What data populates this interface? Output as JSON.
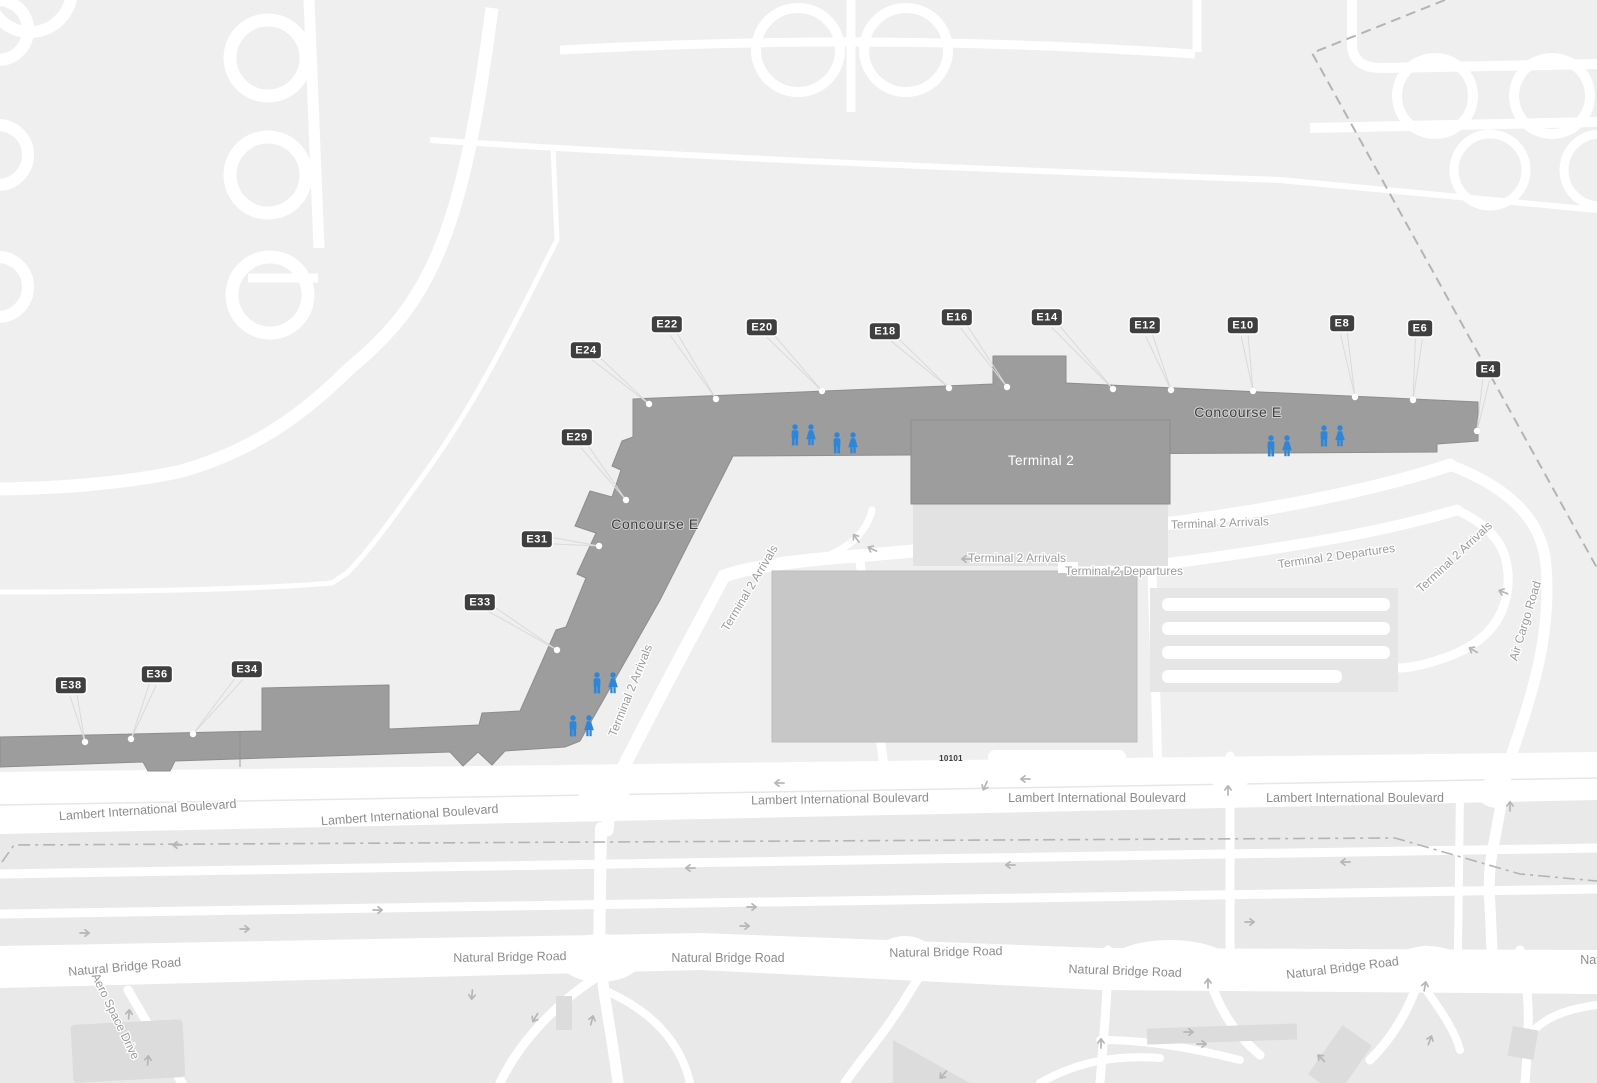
{
  "colors": {
    "map_bg": "#efefef",
    "south_bg": "#e9e9e9",
    "road": "#ffffff",
    "building": "#9d9d9d",
    "building_edge": "#8d8d8d",
    "terminal_apron": "#e2e2e2",
    "garage": "#c7c7c7",
    "badge_bg": "#3f3f3f",
    "badge_text": "#ffffff",
    "label_gray": "#9b9b9b",
    "leader_line": "#dadada",
    "dash_line": "#b4b4b4",
    "arrow": "#b6b6b6",
    "restroom_blue": "#2e86d8"
  },
  "buildings": {
    "concourse_label": "Concourse E",
    "terminal_label": "Terminal 2",
    "garage_address": "10101"
  },
  "gates": [
    {
      "label": "E4",
      "x": 1488,
      "y": 369,
      "dot": [
        1477,
        431
      ]
    },
    {
      "label": "E6",
      "x": 1420,
      "y": 328,
      "dot": [
        1413,
        400
      ]
    },
    {
      "label": "E8",
      "x": 1342,
      "y": 323,
      "dot": [
        1355,
        397
      ]
    },
    {
      "label": "E10",
      "x": 1243,
      "y": 325,
      "dot": [
        1253,
        391
      ]
    },
    {
      "label": "E12",
      "x": 1145,
      "y": 325,
      "dot": [
        1171,
        390
      ]
    },
    {
      "label": "E14",
      "x": 1047,
      "y": 317,
      "dot": [
        1113,
        389
      ]
    },
    {
      "label": "E16",
      "x": 957,
      "y": 317,
      "dot": [
        1007,
        387
      ]
    },
    {
      "label": "E18",
      "x": 885,
      "y": 331,
      "dot": [
        949,
        388
      ]
    },
    {
      "label": "E20",
      "x": 762,
      "y": 327,
      "dot": [
        822,
        391
      ]
    },
    {
      "label": "E22",
      "x": 667,
      "y": 324,
      "dot": [
        716,
        399
      ]
    },
    {
      "label": "E24",
      "x": 586,
      "y": 350,
      "dot": [
        649,
        404
      ]
    },
    {
      "label": "E29",
      "x": 577,
      "y": 437,
      "dot": [
        626,
        500
      ]
    },
    {
      "label": "E31",
      "x": 537,
      "y": 539,
      "dot": [
        599,
        546
      ]
    },
    {
      "label": "E33",
      "x": 480,
      "y": 602,
      "dot": [
        557,
        650
      ]
    },
    {
      "label": "E34",
      "x": 247,
      "y": 669,
      "dot": [
        193,
        734
      ]
    },
    {
      "label": "E36",
      "x": 157,
      "y": 674,
      "dot": [
        131,
        739
      ]
    },
    {
      "label": "E38",
      "x": 71,
      "y": 685,
      "dot": [
        85,
        742
      ]
    }
  ],
  "labels": [
    {
      "text": "Concourse E",
      "x": 1238,
      "y": 417,
      "rot": 0,
      "cls": "ce"
    },
    {
      "text": "Concourse E",
      "x": 655,
      "y": 529,
      "rot": 0,
      "cls": "ce"
    },
    {
      "text": "Terminal 2",
      "x": 1041,
      "y": 465,
      "rot": 0,
      "cls": "t2"
    },
    {
      "text": "10101",
      "x": 951,
      "y": 761,
      "rot": 0,
      "cls": "addr"
    },
    {
      "text": "Terminal 2 Arrivals",
      "x": 1220,
      "y": 527,
      "rot": -2,
      "cls": "road"
    },
    {
      "text": "Terminal 2 Arrivals",
      "x": 1017,
      "y": 562,
      "rot": 0,
      "cls": "road"
    },
    {
      "text": "Terminal 2 Departures",
      "x": 1124,
      "y": 575,
      "rot": 0,
      "cls": "road"
    },
    {
      "text": "Terminal 2 Departures",
      "x": 1337,
      "y": 560,
      "rot": -8,
      "cls": "road"
    },
    {
      "text": "Terminal 2 Arrivals",
      "x": 1457,
      "y": 560,
      "rot": -43,
      "cls": "road"
    },
    {
      "text": "Terminal 2 Arrivals",
      "x": 753,
      "y": 590,
      "rot": -59,
      "cls": "road"
    },
    {
      "text": "Terminal 2 Arrivals",
      "x": 634,
      "y": 692,
      "rot": -68,
      "cls": "road"
    },
    {
      "text": "Air Cargo Road",
      "x": 1529,
      "y": 622,
      "rot": -73,
      "cls": "road"
    },
    {
      "text": "Lambert International Boulevard",
      "x": 148,
      "y": 814,
      "rot": -4,
      "cls": "blvd"
    },
    {
      "text": "Lambert International Boulevard",
      "x": 410,
      "y": 819,
      "rot": -4,
      "cls": "blvd"
    },
    {
      "text": "Lambert International Boulevard",
      "x": 840,
      "y": 803,
      "rot": -1,
      "cls": "blvd"
    },
    {
      "text": "Lambert International Boulevard",
      "x": 1097,
      "y": 802,
      "rot": 0,
      "cls": "blvd"
    },
    {
      "text": "Lambert International Boulevard",
      "x": 1355,
      "y": 802,
      "rot": 0,
      "cls": "blvd"
    },
    {
      "text": "Natural Bridge Road",
      "x": 125,
      "y": 971,
      "rot": -5,
      "cls": "blvd"
    },
    {
      "text": "Natural Bridge Road",
      "x": 510,
      "y": 961,
      "rot": -1,
      "cls": "blvd"
    },
    {
      "text": "Natural Bridge Road",
      "x": 728,
      "y": 962,
      "rot": 0,
      "cls": "blvd"
    },
    {
      "text": "Natural Bridge Road",
      "x": 946,
      "y": 956,
      "rot": -1,
      "cls": "blvd"
    },
    {
      "text": "Natural Bridge Road",
      "x": 1125,
      "y": 975,
      "rot": 2,
      "cls": "blvd"
    },
    {
      "text": "Natural Bridge Road",
      "x": 1343,
      "y": 972,
      "rot": -7,
      "cls": "blvd"
    },
    {
      "text": "Nat",
      "x": 1590,
      "y": 964,
      "rot": 0,
      "cls": "blvd"
    },
    {
      "text": "Aero Space Drive",
      "x": 112,
      "y": 1018,
      "rot": 64,
      "cls": "road"
    }
  ],
  "restrooms": [
    {
      "x": 803,
      "y": 435
    },
    {
      "x": 845,
      "y": 443
    },
    {
      "x": 1279,
      "y": 446
    },
    {
      "x": 1332,
      "y": 436
    },
    {
      "x": 605,
      "y": 683
    },
    {
      "x": 581,
      "y": 726
    }
  ],
  "arrows": [
    {
      "x": 966,
      "y": 559,
      "rot": 180
    },
    {
      "x": 872,
      "y": 549,
      "rot": 205
    },
    {
      "x": 856,
      "y": 538,
      "rot": 235
    },
    {
      "x": 1025,
      "y": 779,
      "rot": 180
    },
    {
      "x": 985,
      "y": 786,
      "rot": 115
    },
    {
      "x": 779,
      "y": 783,
      "rot": 180
    },
    {
      "x": 177,
      "y": 845,
      "rot": 180
    },
    {
      "x": 690,
      "y": 868,
      "rot": 180
    },
    {
      "x": 1010,
      "y": 865,
      "rot": 180
    },
    {
      "x": 1345,
      "y": 862,
      "rot": 180
    },
    {
      "x": 378,
      "y": 910,
      "rot": 0
    },
    {
      "x": 752,
      "y": 907,
      "rot": 0
    },
    {
      "x": 245,
      "y": 929,
      "rot": 0
    },
    {
      "x": 745,
      "y": 926,
      "rot": 0
    },
    {
      "x": 1250,
      "y": 922,
      "rot": 0
    },
    {
      "x": 85,
      "y": 933,
      "rot": 0
    },
    {
      "x": 1503,
      "y": 592,
      "rot": 200
    },
    {
      "x": 1473,
      "y": 650,
      "rot": 210
    },
    {
      "x": 1510,
      "y": 806,
      "rot": -90
    },
    {
      "x": 1228,
      "y": 790,
      "rot": -90
    },
    {
      "x": 472,
      "y": 995,
      "rot": 95
    },
    {
      "x": 535,
      "y": 1018,
      "rot": 120
    },
    {
      "x": 592,
      "y": 1020,
      "rot": -75
    },
    {
      "x": 129,
      "y": 1014,
      "rot": -85
    },
    {
      "x": 148,
      "y": 1060,
      "rot": -85
    },
    {
      "x": 943,
      "y": 1075,
      "rot": 130
    },
    {
      "x": 1208,
      "y": 983,
      "rot": -90
    },
    {
      "x": 1425,
      "y": 986,
      "rot": -80
    },
    {
      "x": 1321,
      "y": 1058,
      "rot": -135
    },
    {
      "x": 1189,
      "y": 1032,
      "rot": 0
    },
    {
      "x": 1202,
      "y": 1044,
      "rot": 0
    },
    {
      "x": 1101,
      "y": 1043,
      "rot": -90
    },
    {
      "x": 1430,
      "y": 1040,
      "rot": -70
    }
  ]
}
